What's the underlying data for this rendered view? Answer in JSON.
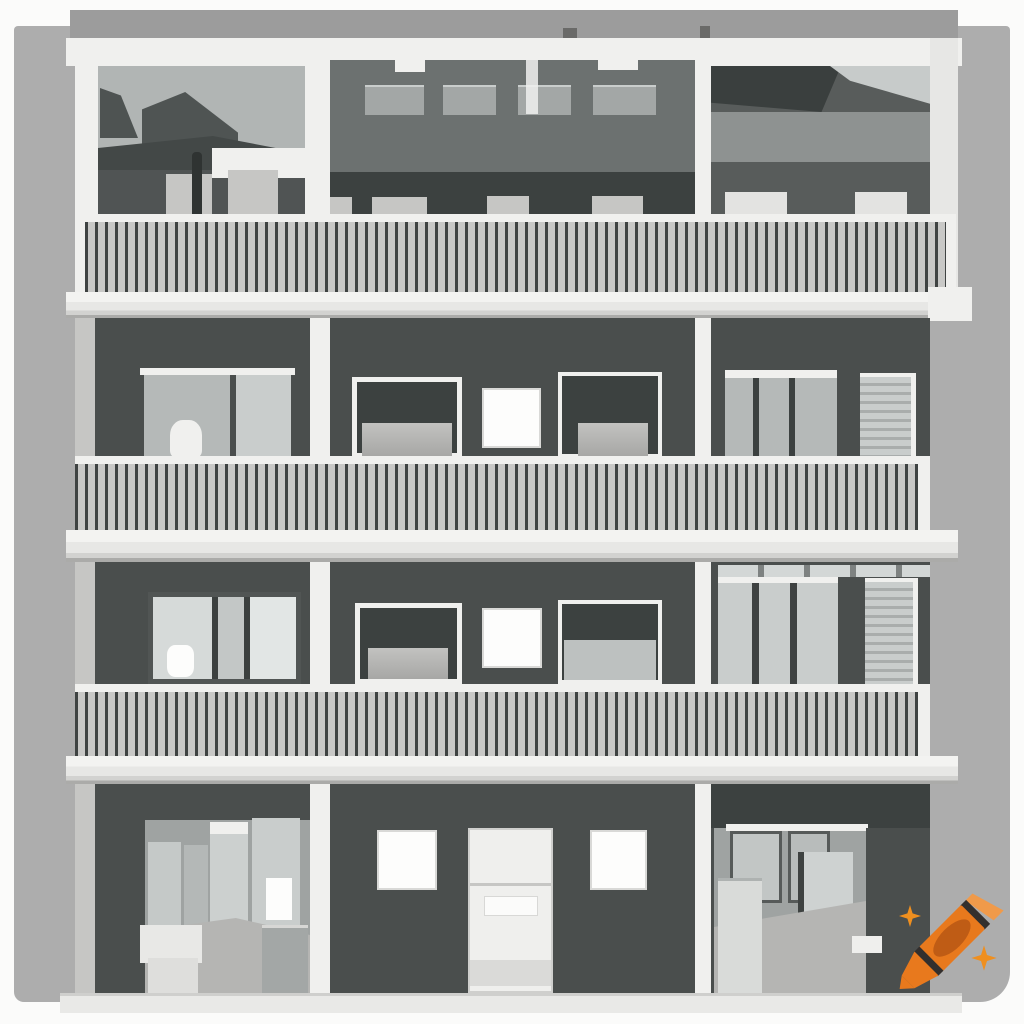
{
  "image": {
    "kind": "ai-generated illustration (Craiyon output)",
    "subject": "Front elevation of a modern four-storey apartment building with balconies",
    "style": "flat grayscale architectural rendering on a light gray backdrop with white margins",
    "text_content": "none",
    "floors_visible": 4,
    "bays_per_floor": 3,
    "balcony_levels_with_railings": 3
  },
  "building": {
    "penthouse": {
      "clerestory_windows": 4,
      "balcony_planters": 8,
      "railing": "vertical balusters"
    },
    "upper_floor": {
      "sliding_glass_door_panels": 2,
      "white_framed_windows": 2,
      "bright_square_window": 1,
      "window_with_blinds": 1
    },
    "middle_floor": {
      "three_pane_window": 1,
      "white_framed_windows": 2,
      "bright_square_window": 1,
      "window_with_blinds": 1
    },
    "ground_floor": {
      "entrance_door": 1,
      "square_windows": 2,
      "open_interior_rooms": 2
    }
  },
  "watermark": {
    "name": "craiyon-crayon-logo",
    "glyph": "orange crayon pointing down-left with two four-pointed sparkles",
    "position": "bottom-right",
    "sparkle_count": 2
  },
  "palette": {
    "page": "#fbfbfa",
    "top_band": "#9c9c9c",
    "backdrop": "#adadad",
    "white_trim": "#f0f0ee",
    "slab": "#e7e7e5",
    "slab_shadow": "#ababa9",
    "facade": "#4a4e4d",
    "facade_dark": "#3c4140",
    "glass": "#b1b5b4",
    "glass_dark": "#505454",
    "penthouse": "#6c7170",
    "window_light": "#a3a7a6",
    "planter": "#c6c6c4",
    "planter_white": "#e3e3e1",
    "rail_dark": "#3f4342",
    "rail_light": "#c8c8c6",
    "pane": "#c9cdcc",
    "pane_dim": "#b5b9b8",
    "sill": "#c2c2c0",
    "interior_wall": "#9fa3a2",
    "interior_floor": "#b5b5b3",
    "door_white": "#efefed",
    "window_white": "#fdfdfc",
    "base_strip": "#e9e9e7",
    "crayon_orange": "#e8791d",
    "crayon_cap": "#f09a4a",
    "crayon_core": "#bf5c15",
    "crayon_band": "#332f2d",
    "sparkle": "#ef8f1f"
  }
}
